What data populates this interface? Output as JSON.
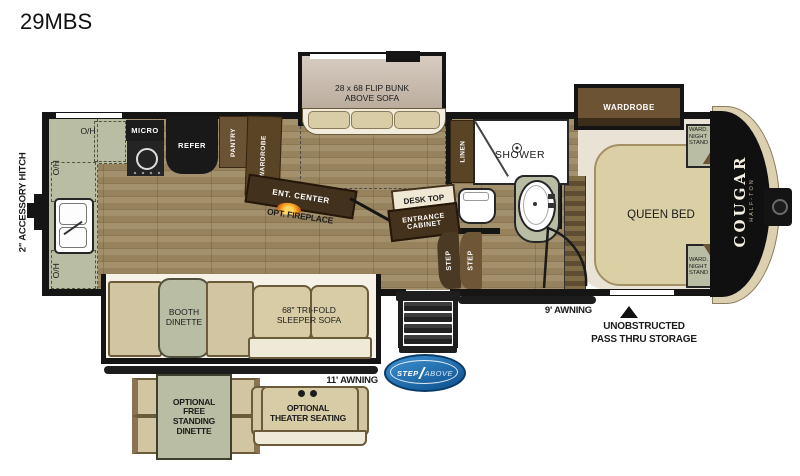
{
  "title": "29MBS",
  "colors": {
    "floor_light": "#a3906c",
    "floor_dark": "#8b7751",
    "counter_sage": "#b9bda3",
    "cabinet_dark_brown": "#45321c",
    "cabinet_brown": "#6a5334",
    "appliance_black": "#1c1c1c",
    "sofa_tan": "#d8cca6",
    "bed_tan": "#dbcfa6",
    "bedroom_floor": "#e9e3d6",
    "wall_black": "#151515",
    "logo_blue": "#1565ad",
    "cap_trim_cream": "#ddd0b0"
  },
  "exterior": {
    "accessory_hitch": "2\" ACCESSORY HITCH",
    "awning_11": "11' AWNING",
    "awning_9": "9' AWNING",
    "pass_thru": [
      "UNOBSTRUCTED",
      "PASS THRU STORAGE"
    ],
    "brand": "COUGAR",
    "brand_sub": "HALF-TON",
    "step_logo": [
      "STEP",
      "ABOVE"
    ]
  },
  "kitchen": {
    "oh": "O/H",
    "micro": "MICRO",
    "refer": "REFER",
    "pantry": "PANTRY",
    "wardrobe": "WARDROBE"
  },
  "living": {
    "flip_bunk": [
      "28 x 68 FLIP BUNK",
      "ABOVE SOFA"
    ],
    "ent_center": "ENT. CENTER",
    "opt_fireplace": "OPT. FIREPLACE",
    "desk_top": "DESK TOP",
    "entrance_cabinet": [
      "ENTRANCE",
      "CABINET"
    ],
    "step": "STEP",
    "sofa": [
      "68\" TRI-FOLD",
      "SLEEPER SOFA"
    ],
    "booth_dinette": [
      "BOOTH",
      "DINETTE"
    ]
  },
  "bathroom": {
    "linen": "LINEN",
    "shower": "SHOWER"
  },
  "bedroom": {
    "wardrobe_slide": "WARDROBE",
    "queen_bed": "QUEEN BED",
    "ward_night_stand": [
      "WARD.",
      "NIGHT",
      "STAND"
    ]
  },
  "options": {
    "free_standing_dinette": [
      "OPTIONAL",
      "FREE",
      "STANDING",
      "DINETTE"
    ],
    "theater_seating": [
      "OPTIONAL",
      "THEATER SEATING"
    ]
  }
}
